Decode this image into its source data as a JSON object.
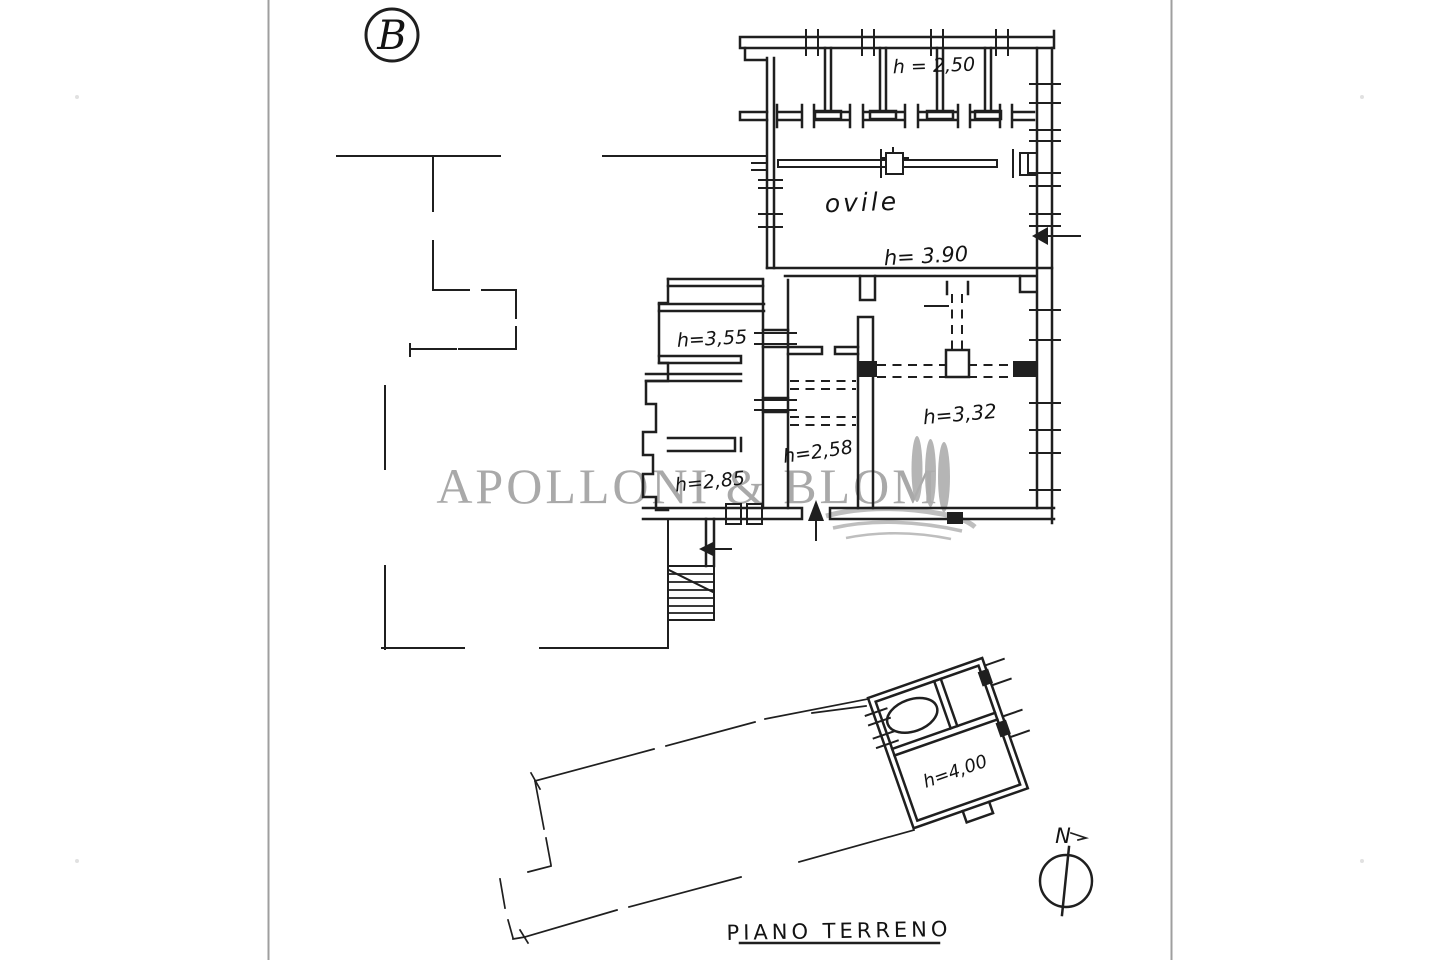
{
  "drawing": {
    "sheet_letter": "B",
    "title": "PIANO TERRENO",
    "north_label": "N"
  },
  "watermark": {
    "name": "APOLLONI & BLOM"
  },
  "labels": {
    "stall_height": "h = 2,50",
    "ovile_name": "ovile",
    "ovile_height": "h= 3.90",
    "room_355_height": "h=3,55",
    "room_285_height": "h=2,85",
    "corridor_height": "h=2,58",
    "room_332_height": "h=3,32",
    "annex_height": "h=4,00"
  },
  "colors": {
    "ink": "#1f1f1f",
    "paper": "#ffffff",
    "page_edge": "#8f8f8f",
    "watermark_gray": "#9e9e9e",
    "watermark_tree": "#adadad"
  }
}
